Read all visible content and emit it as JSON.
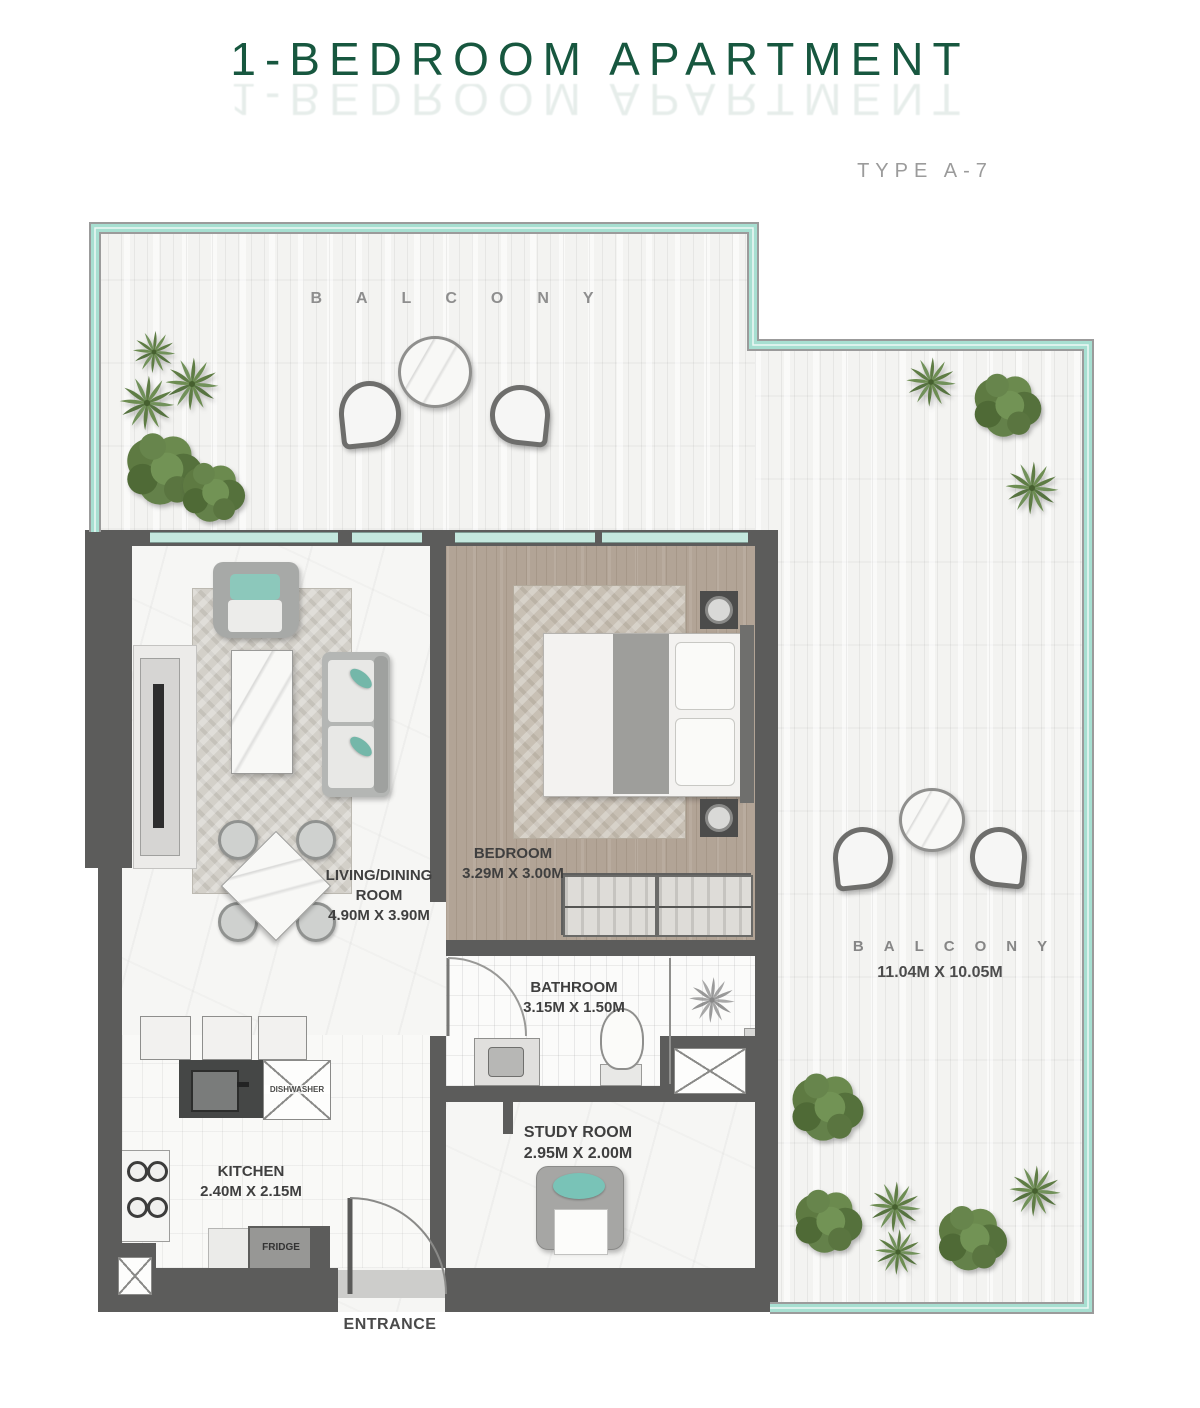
{
  "header": {
    "title": "1-BEDROOM APARTMENT",
    "subtitle": "TYPE A-7"
  },
  "plan": {
    "balcony_top": {
      "label": "BALCONY"
    },
    "balcony_right": {
      "label": "BALCONY",
      "dimensions": "11.04M X 10.05M"
    },
    "living_dining": {
      "line1": "LIVING/DINING",
      "line2": "ROOM",
      "dimensions": "4.90M X 3.90M"
    },
    "bedroom": {
      "label": "BEDROOM",
      "dimensions": "3.29M X 3.00M"
    },
    "bathroom": {
      "label": "BATHROOM",
      "dimensions": "3.15M X 1.50M"
    },
    "study_room": {
      "label": "STUDY ROOM",
      "dimensions": "2.95M X 2.00M"
    },
    "kitchen": {
      "label": "KITCHEN",
      "dimensions": "2.40M X 2.15M"
    },
    "entrance": {
      "label": "ENTRANCE"
    },
    "fridge": {
      "label": "FRIDGE"
    },
    "dishwasher": {
      "label": "DISHWASHER"
    }
  },
  "colors": {
    "title_green": "#17573f",
    "subtitle_gray": "#9b9b9b",
    "wall_dark": "#5c5c5b",
    "balcony_trim_teal": "#a7dfd1",
    "glass_teal": "#c4e8de",
    "accent_teal": "#79c3b7",
    "label_gray": "#3f3f3f"
  }
}
